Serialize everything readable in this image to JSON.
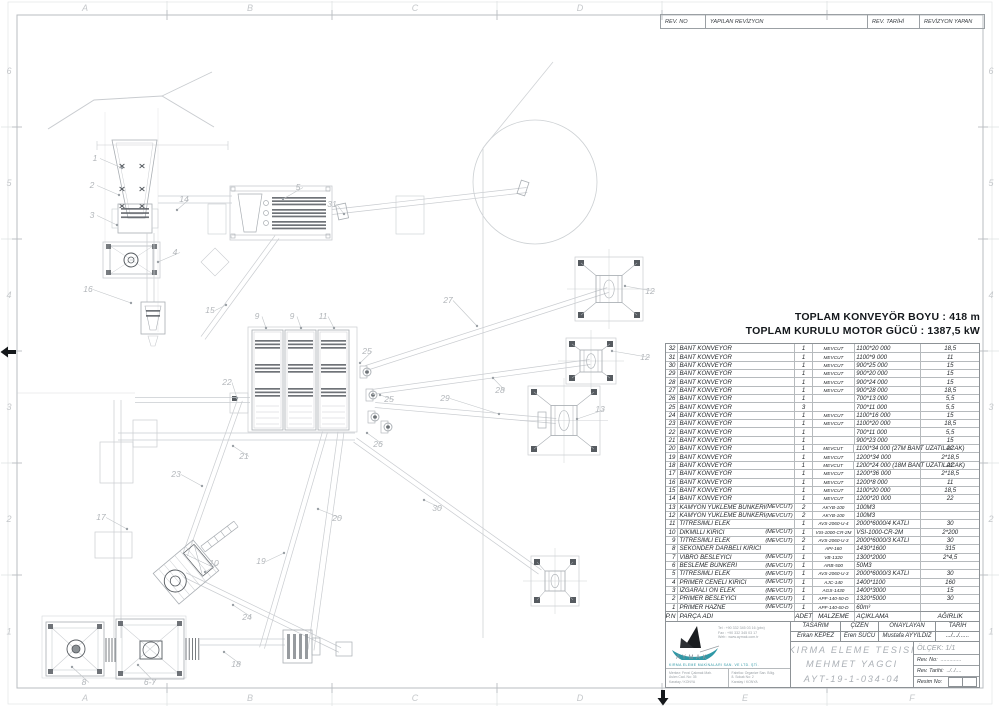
{
  "sheet": {
    "bg": "#ffffff",
    "line_light": "#c9ccd0",
    "line_mid": "#a9aeb3",
    "line_dark": "#565b60",
    "accent_teal": "#2f98a6"
  },
  "ruler": {
    "top_letters": [
      "A",
      "B",
      "C",
      "D"
    ],
    "bottom_letters": [
      "A",
      "B",
      "C",
      "D",
      "E",
      "F"
    ],
    "left_numbers": [
      "6",
      "5",
      "4",
      "3",
      "2",
      "1"
    ],
    "right_numbers": [
      "6",
      "5",
      "4",
      "3",
      "2",
      "1"
    ]
  },
  "revision_header": {
    "rev_no": "REV. NO",
    "yapilan": "YAPILAN REVİZYON",
    "rev_tarihi": "REV. TARİHİ",
    "revizyon_yapan": "REVİZYON YAPAN"
  },
  "totals": {
    "line1": "TOPLAM KONVEYÖR BOYU : 418 m",
    "line2": "TOPLAM KURULU MOTOR GÜCÜ : 1387,5 kW"
  },
  "parts_table": {
    "headers": {
      "pn": "P.N",
      "name": "PARÇA ADI",
      "qty": "ADET",
      "material": "MALZEME",
      "desc": "AÇIKLAMA",
      "weight": "AĞIRLIK"
    },
    "rows": [
      {
        "pn": "32",
        "name": "BANT KONVEYOR",
        "note": "",
        "qty": "1",
        "mat": "MEVCUT",
        "desc": "1100*20 000",
        "wt": "18,5"
      },
      {
        "pn": "31",
        "name": "BANT KONVEYOR",
        "note": "",
        "qty": "1",
        "mat": "MEVCUT",
        "desc": "1100*9 000",
        "wt": "11"
      },
      {
        "pn": "30",
        "name": "BANT KONVEYOR",
        "note": "",
        "qty": "1",
        "mat": "MEVCUT",
        "desc": "900*25 000",
        "wt": "15"
      },
      {
        "pn": "29",
        "name": "BANT KONVEYOR",
        "note": "",
        "qty": "1",
        "mat": "MEVCUT",
        "desc": "900*20 000",
        "wt": "15"
      },
      {
        "pn": "28",
        "name": "BANT KONVEYOR",
        "note": "",
        "qty": "1",
        "mat": "MEVCUT",
        "desc": "900*24 000",
        "wt": "15"
      },
      {
        "pn": "27",
        "name": "BANT KONVEYOR",
        "note": "",
        "qty": "1",
        "mat": "MEVCUT",
        "desc": "900*28 000",
        "wt": "18,5"
      },
      {
        "pn": "26",
        "name": "BANT KONVEYOR",
        "note": "",
        "qty": "1",
        "mat": "",
        "desc": "700*13 000",
        "wt": "5,5"
      },
      {
        "pn": "25",
        "name": "BANT KONVEYOR",
        "note": "",
        "qty": "3",
        "mat": "",
        "desc": "700*11 000",
        "wt": "5,5"
      },
      {
        "pn": "24",
        "name": "BANT KONVEYOR",
        "note": "",
        "qty": "1",
        "mat": "MEVCUT",
        "desc": "1100*16 000",
        "wt": "15"
      },
      {
        "pn": "23",
        "name": "BANT KONVEYOR",
        "note": "",
        "qty": "1",
        "mat": "MEVCUT",
        "desc": "1100*20 000",
        "wt": "18,5"
      },
      {
        "pn": "22",
        "name": "BANT KONVEYOR",
        "note": "",
        "qty": "1",
        "mat": "",
        "desc": "700*11 000",
        "wt": "5,5"
      },
      {
        "pn": "21",
        "name": "BANT KONVEYOR",
        "note": "",
        "qty": "1",
        "mat": "",
        "desc": "900*23 000",
        "wt": "15"
      },
      {
        "pn": "20",
        "name": "BANT KONVEYOR",
        "note": "",
        "qty": "1",
        "mat": "MEVCUT",
        "desc": "1100*34 000 (27M BANT UZATILACAK)",
        "wt": "22"
      },
      {
        "pn": "19",
        "name": "BANT KONVEYOR",
        "note": "",
        "qty": "1",
        "mat": "MEVCUT",
        "desc": "1200*34 000",
        "wt": "2*18,5"
      },
      {
        "pn": "18",
        "name": "BANT KONVEYOR",
        "note": "",
        "qty": "1",
        "mat": "MEVCUT",
        "desc": "1200*24 000 (18M BANT UZATILACAK)",
        "wt": "22"
      },
      {
        "pn": "17",
        "name": "BANT KONVEYOR",
        "note": "",
        "qty": "1",
        "mat": "MEVCUT",
        "desc": "1200*36 000",
        "wt": "2*18,5"
      },
      {
        "pn": "16",
        "name": "BANT KONVEYOR",
        "note": "",
        "qty": "1",
        "mat": "MEVCUT",
        "desc": "1200*8 000",
        "wt": "11"
      },
      {
        "pn": "15",
        "name": "BANT KONVEYOR",
        "note": "",
        "qty": "1",
        "mat": "MEVCUT",
        "desc": "1100*20 000",
        "wt": "18,5"
      },
      {
        "pn": "14",
        "name": "BANT KONVEYOR",
        "note": "",
        "qty": "1",
        "mat": "MEVCUT",
        "desc": "1200*20 000",
        "wt": "22"
      },
      {
        "pn": "13",
        "name": "KAMYON YUKLEME BUNKERI",
        "note": "(MEVCUT)",
        "qty": "2",
        "mat": "AKYB-100",
        "desc": "100M3",
        "wt": ""
      },
      {
        "pn": "12",
        "name": "KAMYON YUKLEME BUNKERI",
        "note": "(MEVCUT)",
        "qty": "2",
        "mat": "AKYB-100",
        "desc": "100M3",
        "wt": ""
      },
      {
        "pn": "11",
        "name": "TITRESIMLI ELEK",
        "note": "",
        "qty": "1",
        "mat": "AVS-2060-U-4",
        "desc": "2000*6000/4 KATLI",
        "wt": "30"
      },
      {
        "pn": "10",
        "name": "DIKMILLI KIRICI",
        "note": "(MEVCUT)",
        "qty": "1",
        "mat": "VSI-1000-CR-2M",
        "desc": "VSI-1000-CR-2M",
        "wt": "2*200"
      },
      {
        "pn": "9",
        "name": "TITRESIMLI ELEK",
        "note": "(MEVCUT)",
        "qty": "2",
        "mat": "AVS-2060-U-3",
        "desc": "2000*6000/3 KATLI",
        "wt": "30"
      },
      {
        "pn": "8",
        "name": "SEKONDER DARBELI KIRICI",
        "note": "",
        "qty": "1",
        "mat": "API-160",
        "desc": "1430*1600",
        "wt": "315"
      },
      {
        "pn": "7",
        "name": "VIBRO BESLEYICI",
        "note": "(MEVCUT)",
        "qty": "1",
        "mat": "VB-1320",
        "desc": "1300*2000",
        "wt": "2*4,5"
      },
      {
        "pn": "6",
        "name": "BESLEME BUNKERI",
        "note": "(MEVCUT)",
        "qty": "1",
        "mat": "ARB-500",
        "desc": "50M3",
        "wt": ""
      },
      {
        "pn": "5",
        "name": "TITRESIMLI ELEK",
        "note": "(MEVCUT)",
        "qty": "1",
        "mat": "AVS-2060-U-3",
        "desc": "2000*6000/3 KATLI",
        "wt": "30"
      },
      {
        "pn": "4",
        "name": "PRIMER CENELI KIRICI",
        "note": "(MEVCUT)",
        "qty": "1",
        "mat": "AJC-140",
        "desc": "1400*1100",
        "wt": "160"
      },
      {
        "pn": "3",
        "name": "IZGARALI ON ELEK",
        "note": "(MEVCUT)",
        "qty": "1",
        "mat": "AGS-1430",
        "desc": "1400*3000",
        "wt": "15"
      },
      {
        "pn": "2",
        "name": "PRIMER BESLEYICI",
        "note": "(MEVCUT)",
        "qty": "1",
        "mat": "APF-140-50-D",
        "desc": "1320*5000",
        "wt": "30"
      },
      {
        "pn": "1",
        "name": "PRIMER HAZNE",
        "note": "(MEVCUT)",
        "qty": "1",
        "mat": "APF-140-60-D",
        "desc": "60m³",
        "wt": ""
      }
    ]
  },
  "title_block": {
    "tasarim_label": "TASARIM",
    "cizen_label": "ÇİZEN",
    "onaylayan_label": "ONAYLAYAN",
    "tarih_label": "TARİH",
    "tasarim": "Erkan KEPEZ",
    "cizen": "Eren SUCU",
    "onaylayan": "Mustafa AYYILDIZ",
    "tarih": ".../.../......",
    "title_line1": "KIRMA ELEME TESISI",
    "title_line2": "MEHMET YAGCI",
    "title_line3": "AYT-19-1-034-04",
    "olcek": "ÖLÇEK:  1/1",
    "rev_no_label": "Rev. No:",
    "rev_no_value": "..............",
    "rev_tarihi_label": "Rev. Tarihi:",
    "rev_tarihi_value": "../../....",
    "resim_no_label": "Resim No:"
  },
  "logo": {
    "company": "AYMAK",
    "tagline": "KIRMA ELEME MAKİNALARI SAN. VE LTD. ŞTİ.",
    "contact_lines": [
      "Tel : +90 332 345 03 16 (pbx)",
      "Fax : +90 332 345 03 17",
      "Web : www.aymak.com.tr"
    ],
    "address_left": [
      "Merkez: Fevzi Çakmak Mah.",
      "Aslım Cad. No: 35",
      "Karatay / KONYA"
    ],
    "address_right": [
      "Fabrika: Organize San. Bölg.",
      "8. Sokak No: 2",
      "Karatay / KONYA"
    ]
  },
  "drawing": {
    "callouts": [
      {
        "t": "1",
        "x": 95,
        "y": 161,
        "tx": 122,
        "ty": 168
      },
      {
        "t": "2",
        "x": 92,
        "y": 188,
        "tx": 119,
        "ty": 195
      },
      {
        "t": "3",
        "x": 92,
        "y": 218,
        "tx": 117,
        "ty": 225
      },
      {
        "t": "4",
        "x": 175,
        "y": 255,
        "tx": 158,
        "ty": 262
      },
      {
        "t": "5",
        "x": 298,
        "y": 190,
        "tx": 283,
        "ty": 199
      },
      {
        "t": "31",
        "x": 332,
        "y": 207,
        "tx": 344,
        "ty": 214
      },
      {
        "t": "14",
        "x": 184,
        "y": 202,
        "tx": 177,
        "ty": 210
      },
      {
        "t": "15",
        "x": 210,
        "y": 313,
        "tx": 226,
        "ty": 305
      },
      {
        "t": "16",
        "x": 88,
        "y": 292,
        "tx": 131,
        "ty": 303
      },
      {
        "t": "9",
        "x": 257,
        "y": 319,
        "tx": 266,
        "ty": 328
      },
      {
        "t": "9",
        "x": 292,
        "y": 319,
        "tx": 301,
        "ty": 328
      },
      {
        "t": "11",
        "x": 323,
        "y": 319,
        "tx": 334,
        "ty": 328
      },
      {
        "t": "25",
        "x": 367,
        "y": 354,
        "tx": 360,
        "ty": 363
      },
      {
        "t": "25",
        "x": 389,
        "y": 402,
        "tx": 380,
        "ty": 395
      },
      {
        "t": "26",
        "x": 378,
        "y": 447,
        "tx": 367,
        "ty": 433
      },
      {
        "t": "27",
        "x": 448,
        "y": 303,
        "tx": 477,
        "ty": 326
      },
      {
        "t": "28",
        "x": 500,
        "y": 393,
        "tx": 493,
        "ty": 378
      },
      {
        "t": "29",
        "x": 445,
        "y": 401,
        "tx": 499,
        "ty": 414
      },
      {
        "t": "30",
        "x": 437,
        "y": 511,
        "tx": 424,
        "ty": 500
      },
      {
        "t": "21",
        "x": 244,
        "y": 459,
        "tx": 233,
        "ty": 446
      },
      {
        "t": "22",
        "x": 227,
        "y": 385,
        "tx": 237,
        "ty": 398
      },
      {
        "t": "23",
        "x": 176,
        "y": 477,
        "tx": 202,
        "ty": 486
      },
      {
        "t": "17",
        "x": 101,
        "y": 520,
        "tx": 127,
        "ty": 529
      },
      {
        "t": "20",
        "x": 337,
        "y": 521,
        "tx": 318,
        "ty": 509
      },
      {
        "t": "19",
        "x": 261,
        "y": 564,
        "tx": 284,
        "ty": 553
      },
      {
        "t": "10",
        "x": 214,
        "y": 566,
        "tx": 205,
        "ty": 572
      },
      {
        "t": "24",
        "x": 247,
        "y": 620,
        "tx": 233,
        "ty": 605
      },
      {
        "t": "18",
        "x": 236,
        "y": 667,
        "tx": 224,
        "ty": 652
      },
      {
        "t": "8",
        "x": 84,
        "y": 685,
        "tx": 72,
        "ty": 667
      },
      {
        "t": "6-7",
        "x": 150,
        "y": 685,
        "tx": 138,
        "ty": 665
      },
      {
        "t": "12",
        "x": 650,
        "y": 294,
        "tx": 625,
        "ty": 286
      },
      {
        "t": "12",
        "x": 645,
        "y": 360,
        "tx": 612,
        "ty": 351
      },
      {
        "t": "13",
        "x": 600,
        "y": 412,
        "tx": 577,
        "ty": 419
      }
    ]
  }
}
